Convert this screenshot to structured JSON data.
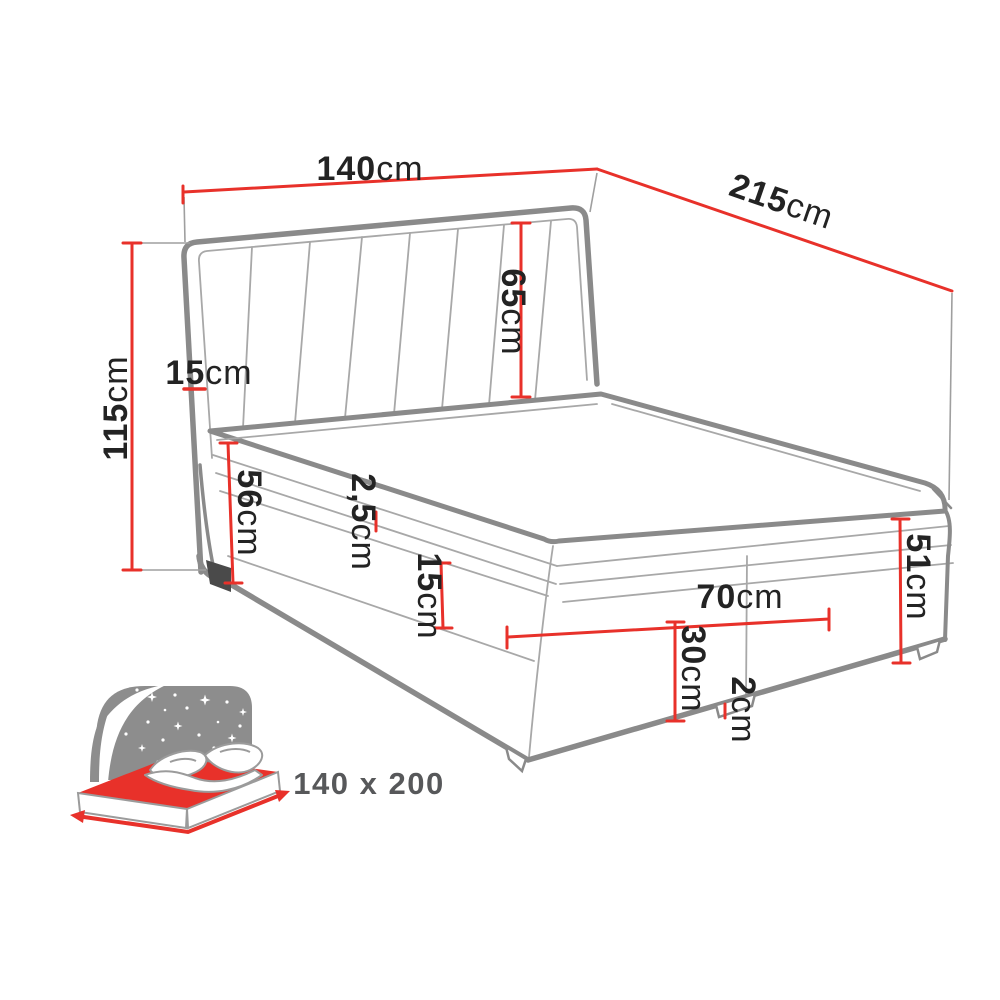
{
  "diagram_title": "boxspring-bed-dimension-diagram",
  "colors": {
    "dimension_red": "#e8312a",
    "outline_gray": "#8a8a8a",
    "seam_gray": "#a8a8a8",
    "icon_gray": "#8d8d8d",
    "label_black": "#232323",
    "size_text_gray": "#57585a"
  },
  "dimensions": {
    "width": {
      "value": "140",
      "unit": "cm"
    },
    "length": {
      "value": "215",
      "unit": "cm"
    },
    "total_height": {
      "value": "115",
      "unit": "cm"
    },
    "headboard_thickness": {
      "value": "15",
      "unit": "cm"
    },
    "headboard_height": {
      "value": "65",
      "unit": "cm"
    },
    "front_height": {
      "value": "56",
      "unit": "cm"
    },
    "topper_thickness": {
      "value": "2,5",
      "unit": "cm"
    },
    "mattress_thickness": {
      "value": "15",
      "unit": "cm"
    },
    "storage_width": {
      "value": "70",
      "unit": "cm"
    },
    "box_section_height": {
      "value": "30",
      "unit": "cm"
    },
    "leg_height": {
      "value": "2",
      "unit": "cm"
    },
    "side_height": {
      "value": "51",
      "unit": "cm"
    }
  },
  "size_badge": {
    "label": "140 x 200"
  }
}
